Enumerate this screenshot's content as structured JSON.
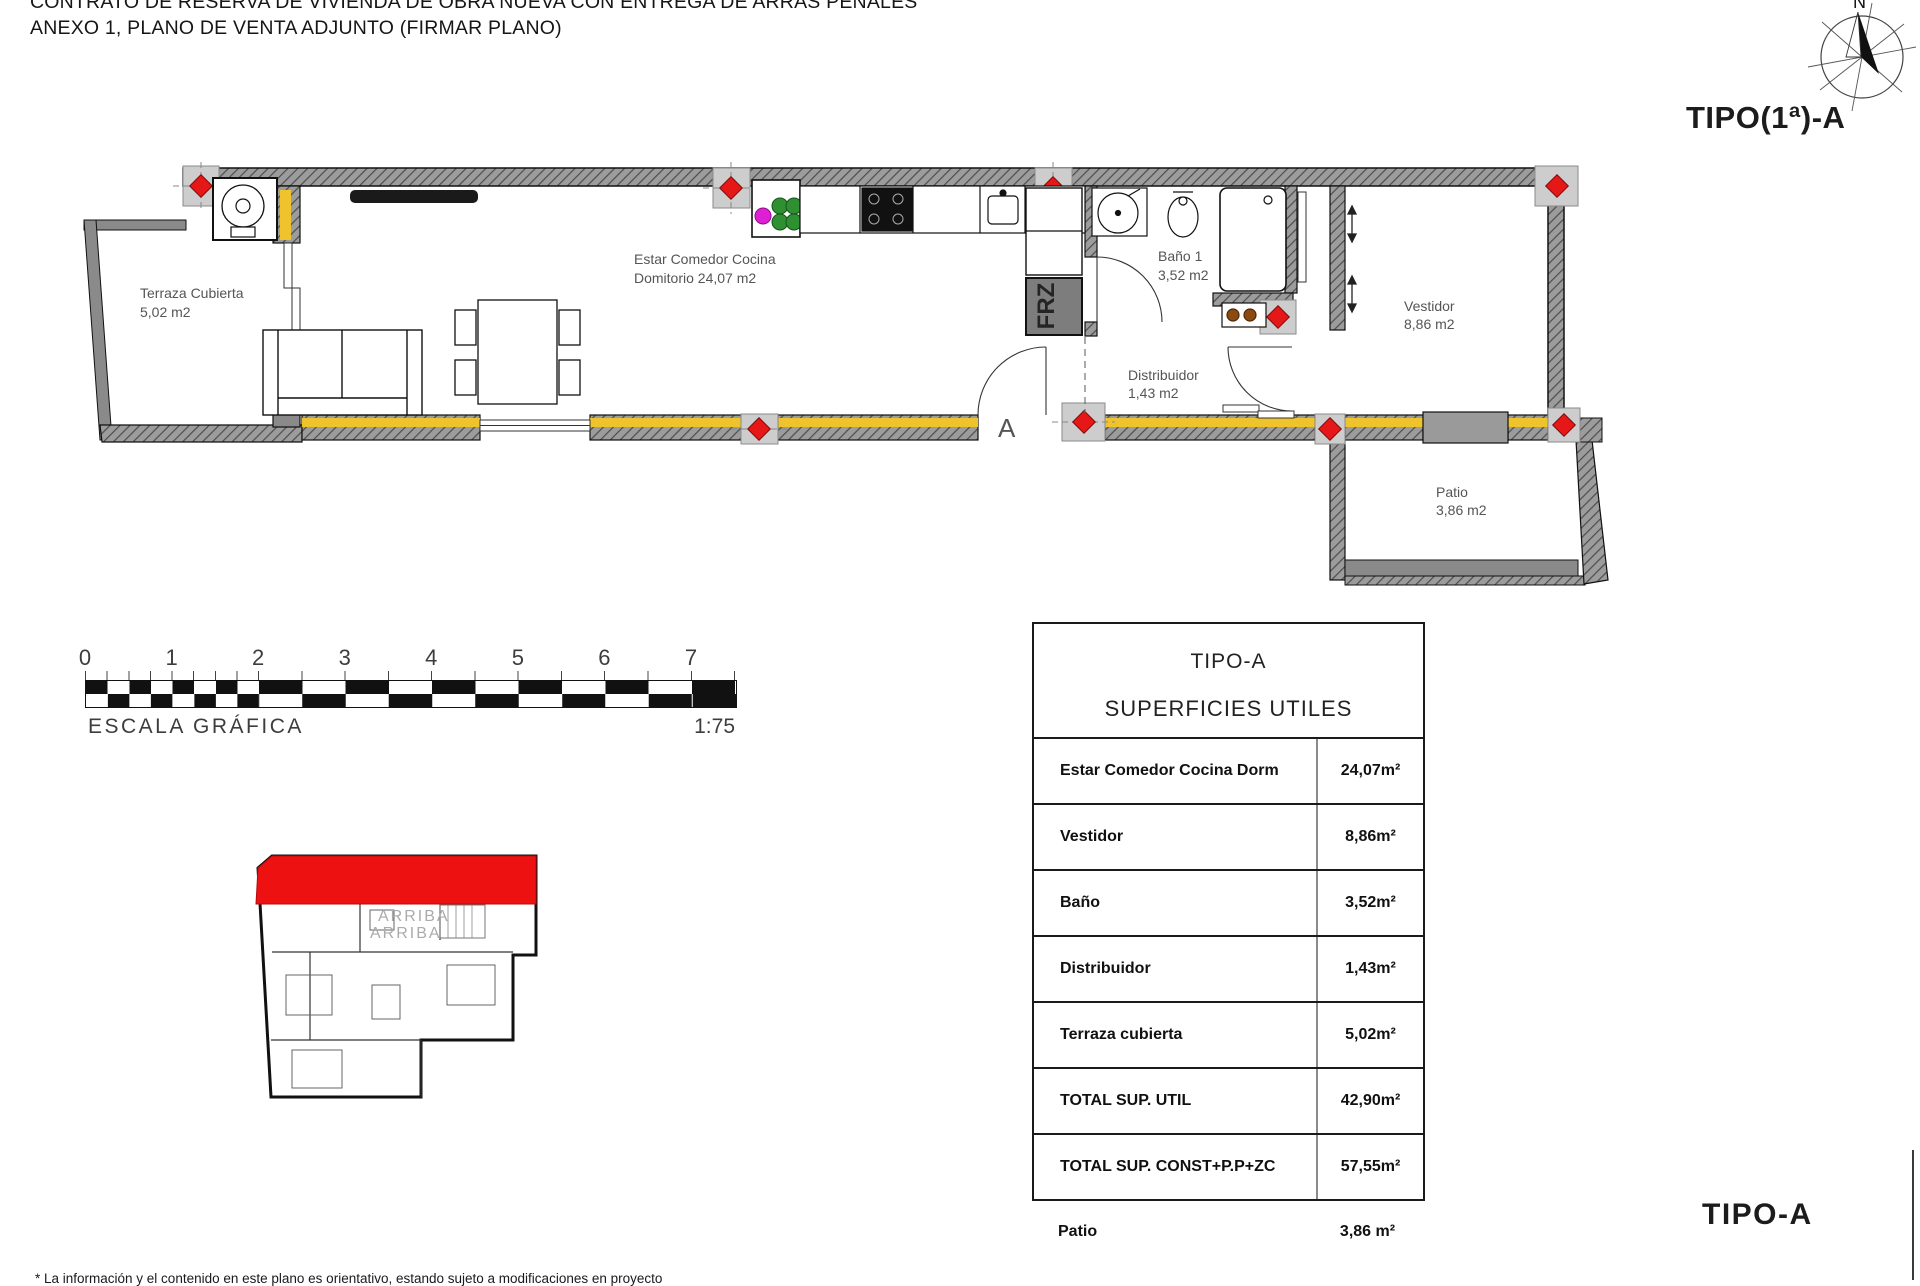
{
  "title": {
    "line1": "CONTRATO DE RESERVA DE VIVIENDA DE OBRA NUEVA CON ENTREGA DE ARRAS PENALES",
    "line2": "ANEXO 1, PLANO DE VENTA ADJUNTO (FIRMAR PLANO)"
  },
  "plan_type_label": "TIPO(1ª)-A",
  "compass": {
    "north_label": "N"
  },
  "rooms": {
    "terraza": {
      "name": "Terraza Cubierta",
      "area": "5,02 m2"
    },
    "estar": {
      "name": "Estar Comedor Cocina",
      "line2": "Domitorio 24,07 m2"
    },
    "bano": {
      "name": "Baño 1",
      "area": "3,52 m2"
    },
    "distribuidor": {
      "name": "Distribuidor",
      "area": "1,43 m2"
    },
    "vestidor": {
      "name": "Vestidor",
      "area": "8,86 m2"
    },
    "patio": {
      "name": "Patio",
      "area": "3,86 m2"
    },
    "frz_label": "FRZ",
    "section_marker": "A"
  },
  "icons": {
    "updown_arrow": "↕"
  },
  "scalebar": {
    "ticks": [
      "0",
      "1",
      "2",
      "3",
      "4",
      "5",
      "6",
      "7"
    ],
    "caption": "ESCALA GRÁFICA",
    "ratio": "1:75"
  },
  "key_plan": {
    "arriba1": "ARRIBA",
    "arriba2": "ARRIBA"
  },
  "table": {
    "title_line1": "TIPO-A",
    "title_line2": "SUPERFICIES UTILES",
    "rows": [
      {
        "label": "Estar Comedor Cocina Dorm",
        "value": "24,07m²"
      },
      {
        "label": "Vestidor",
        "value": "8,86m²"
      },
      {
        "label": "Baño",
        "value": "3,52m²"
      },
      {
        "label": "Distribuidor",
        "value": "1,43m²"
      },
      {
        "label": "Terraza cubierta",
        "value": "5,02m²"
      },
      {
        "label": "TOTAL SUP. UTIL",
        "value": "42,90m²"
      },
      {
        "label": "TOTAL SUP. CONST+P.P+ZC",
        "value": "57,55m²"
      }
    ],
    "extra_row": {
      "label": "Patio",
      "value": "3,86 m²"
    }
  },
  "footer": {
    "type_label": "TIPO-A",
    "disclaimer": "* La información y el contenido en este plano es orientativo, estando sujeto a modificaciones en proyecto"
  },
  "colors": {
    "wall_hatch": "#9c9c9c",
    "insulation": "#efc32b",
    "pillar_red": "#e61717",
    "key_highlight": "#ee1111"
  }
}
